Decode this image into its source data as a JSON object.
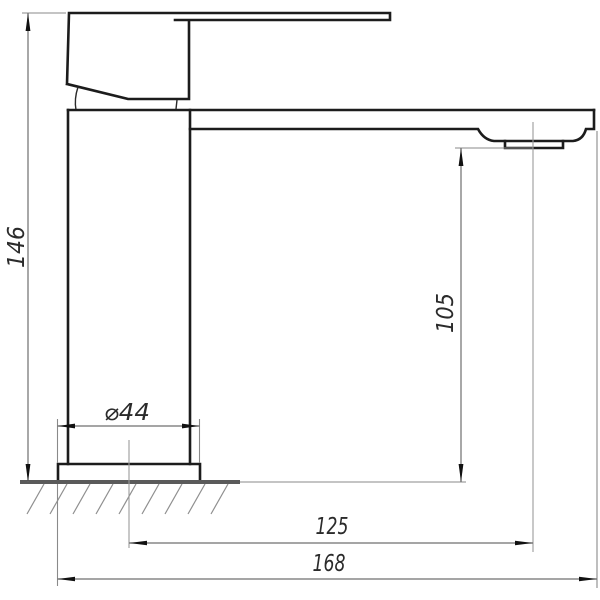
{
  "drawing": {
    "dimensions": {
      "total_height": "146",
      "outlet_height": "105",
      "base_diameter": "⌀44",
      "spout_reach": "125",
      "overall_reach": "168"
    }
  }
}
